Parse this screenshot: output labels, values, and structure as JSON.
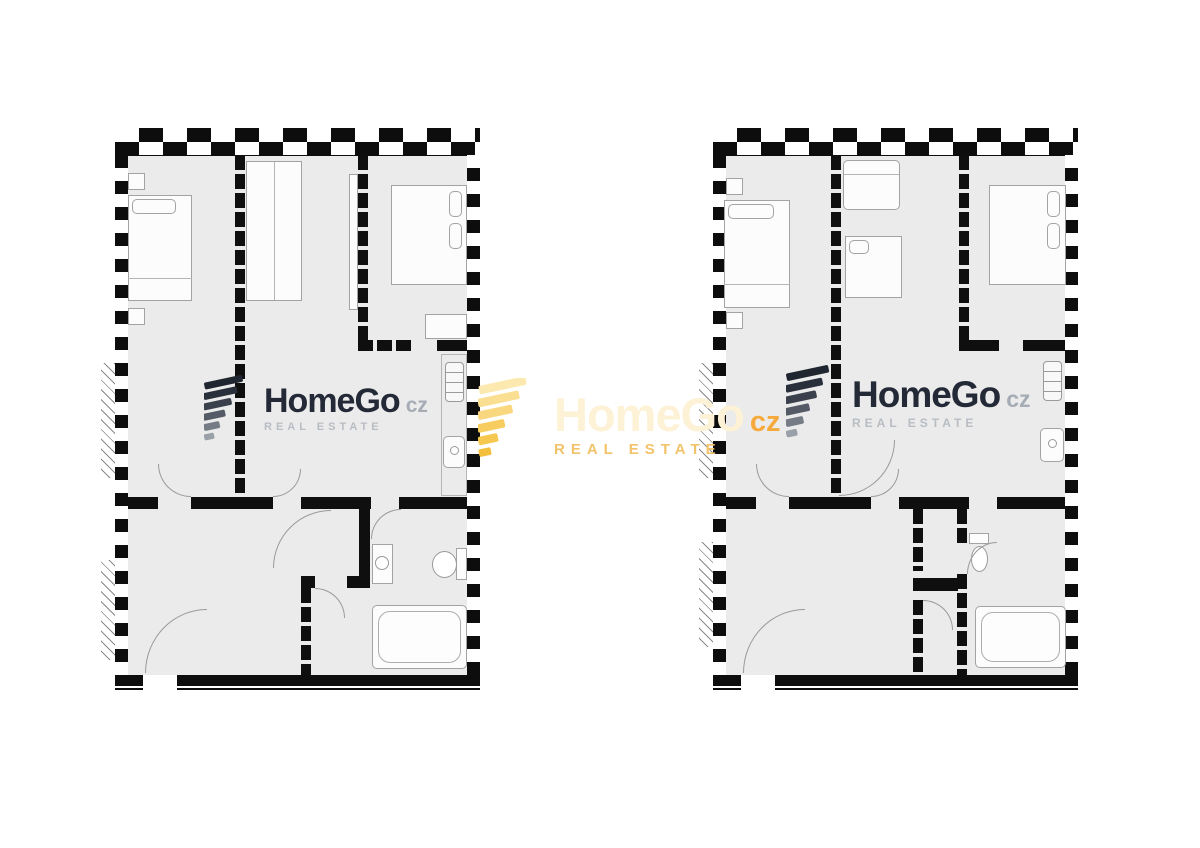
{
  "watermarks": {
    "left": {
      "brand": "HomeGo",
      "suffix": "cz",
      "tagline": "REAL ESTATE"
    },
    "center": {
      "brand": "HomeGo",
      "suffix": "cz",
      "tagline": "REAL ESTATE"
    },
    "right": {
      "brand": "HomeGo",
      "suffix": "cz",
      "tagline": "REAL ESTATE"
    }
  },
  "icons": {
    "watermark_icon": "homego-fan-icon"
  },
  "colors": {
    "background": "#ffffff",
    "floor": "#ebebeb",
    "wall": "#0d0d0d",
    "furniture_outline": "#a3a3a3",
    "brand_dark": "#232936",
    "suffix_gray": "#a6acb5",
    "tagline_gray": "#b8bdc4",
    "brand_cream": "#fdf2d6",
    "suffix_gold": "#f6aa3d",
    "tagline_gold": "#f2c36b",
    "icon_gold": "#f6c84f",
    "icon_dark": "#262c38"
  },
  "plans": {
    "count": 2
  }
}
